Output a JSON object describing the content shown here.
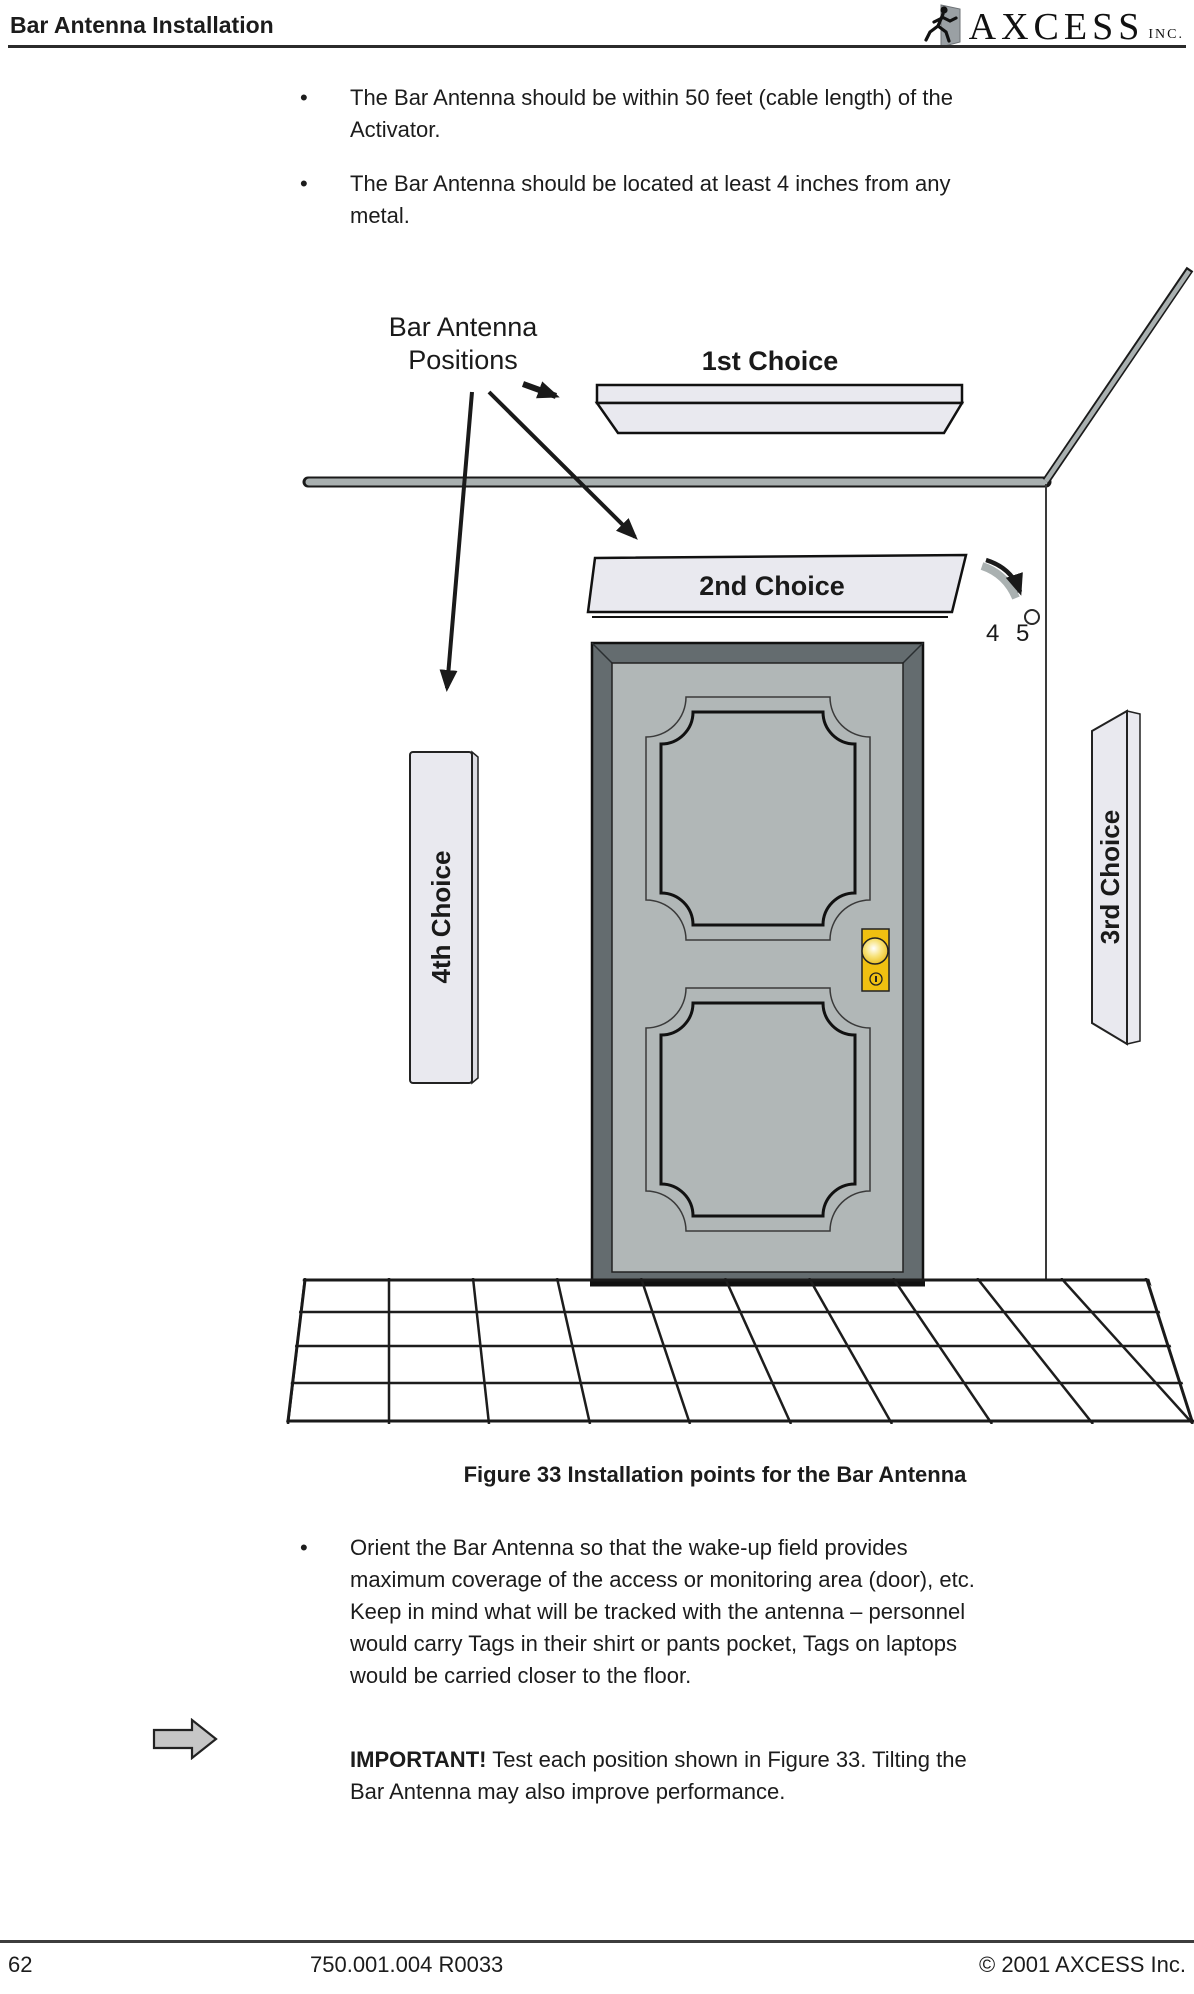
{
  "header": {
    "title": "Bar Antenna Installation"
  },
  "logo": {
    "brand": "AXCESS",
    "suffix": "INC."
  },
  "bullet_char": "•",
  "intro_bullets": {
    "b1": "The Bar Antenna should be within 50 feet (cable length) of the\nActivator.",
    "b2": "The Bar Antenna should be located at least 4 inches from any\nmetal."
  },
  "figure": {
    "positions_line1": "Bar Antenna",
    "positions_line2": "Positions",
    "choice1": "1st Choice",
    "choice2": "2nd Choice",
    "choice3": "3rd Choice",
    "choice4": "4th Choice",
    "angle": "4 5",
    "caption": "Figure 33 Installation points for the Bar Antenna"
  },
  "body_bullets": {
    "b1": "Orient the Bar Antenna so that the wake-up field provides\nmaximum coverage of the access or monitoring area (door), etc.\nKeep in mind what will be tracked with the antenna – personnel\nwould carry Tags in their shirt or pants pocket, Tags on laptops\nwould be carried closer to the floor."
  },
  "important": {
    "label": "IMPORTANT!",
    "text": "Test each position shown in Figure 33. Tilting the\nBar Antenna may also improve performance."
  },
  "footer": {
    "page_number": "62",
    "doc_number": "750.001.004 R0033",
    "copyright": "© 2001 AXCESS Inc."
  },
  "colors": {
    "antenna_fill": "#e9e9ef",
    "wall_gray": "#a9b0b0",
    "door_frame": "#646c6f",
    "door_face": "#b1b7b7",
    "knob_gold": "#f0c011",
    "icon_gray": "#c6c6c6"
  }
}
